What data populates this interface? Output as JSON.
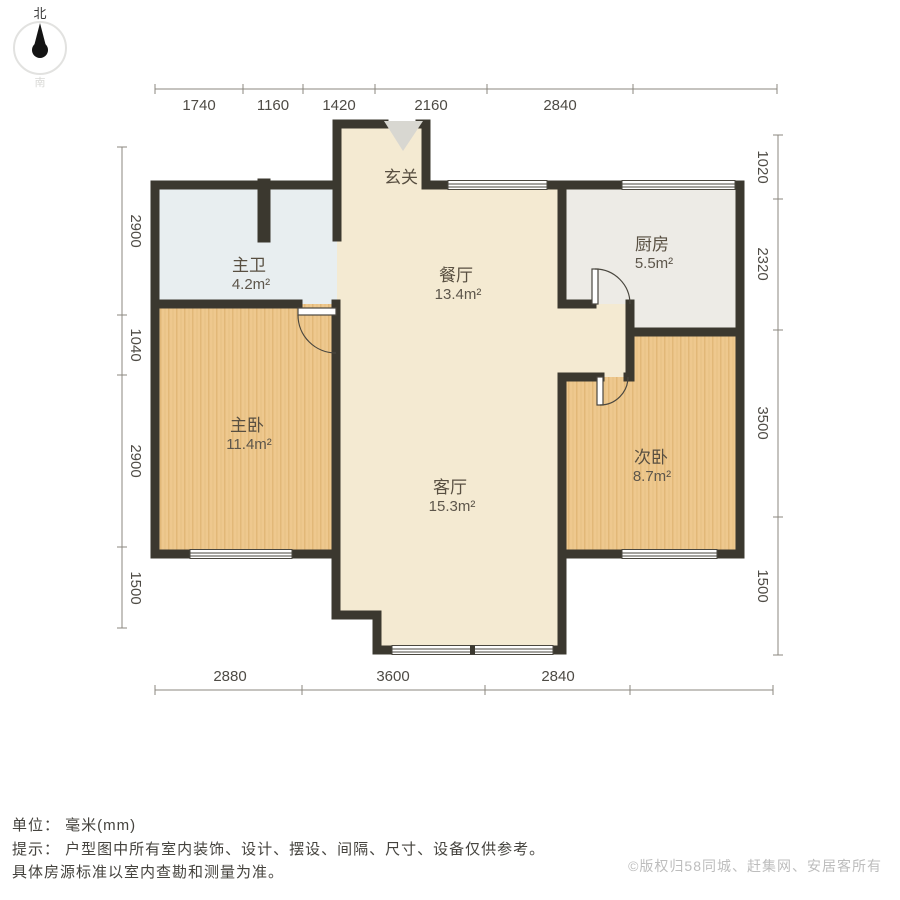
{
  "compass": {
    "north_label": "北",
    "south_label": "南"
  },
  "rooms": [
    {
      "name": "玄关",
      "area": ""
    },
    {
      "name": "餐厅",
      "area": "13.4m²"
    },
    {
      "name": "厨房",
      "area": "5.5m²"
    },
    {
      "name": "主卫",
      "area": "4.2m²"
    },
    {
      "name": "主卧",
      "area": "11.4m²"
    },
    {
      "name": "客厅",
      "area": "15.3m²"
    },
    {
      "name": "次卧",
      "area": "8.7m²"
    }
  ],
  "dimensions": {
    "top": [
      "1740",
      "1160",
      "1420",
      "2160",
      "2840"
    ],
    "bottom": [
      "2880",
      "3600",
      "2840"
    ],
    "left": [
      "2900",
      "1040",
      "2900",
      "1500"
    ],
    "right": [
      "1020",
      "2320",
      "3500",
      "1500"
    ]
  },
  "footer": {
    "unit_line": "单位： 毫米(mm)",
    "tip_line1": "提示： 户型图中所有室内装饰、设计、摆设、间隔、尺寸、设备仅供参考。",
    "tip_line2": "具体房源标准以室内查勘和测量为准。",
    "copyright": "©版权归58同城、赶集网、安居客所有"
  },
  "colors": {
    "wall": "#3b382f",
    "floor_main": "#f4ead2",
    "floor_wood": "#eec88e",
    "floor_bath": "#e8eef0",
    "floor_kitchen": "#edebe6",
    "dim_line": "#8b877f",
    "entry_arrow": "#d8d7d1"
  }
}
